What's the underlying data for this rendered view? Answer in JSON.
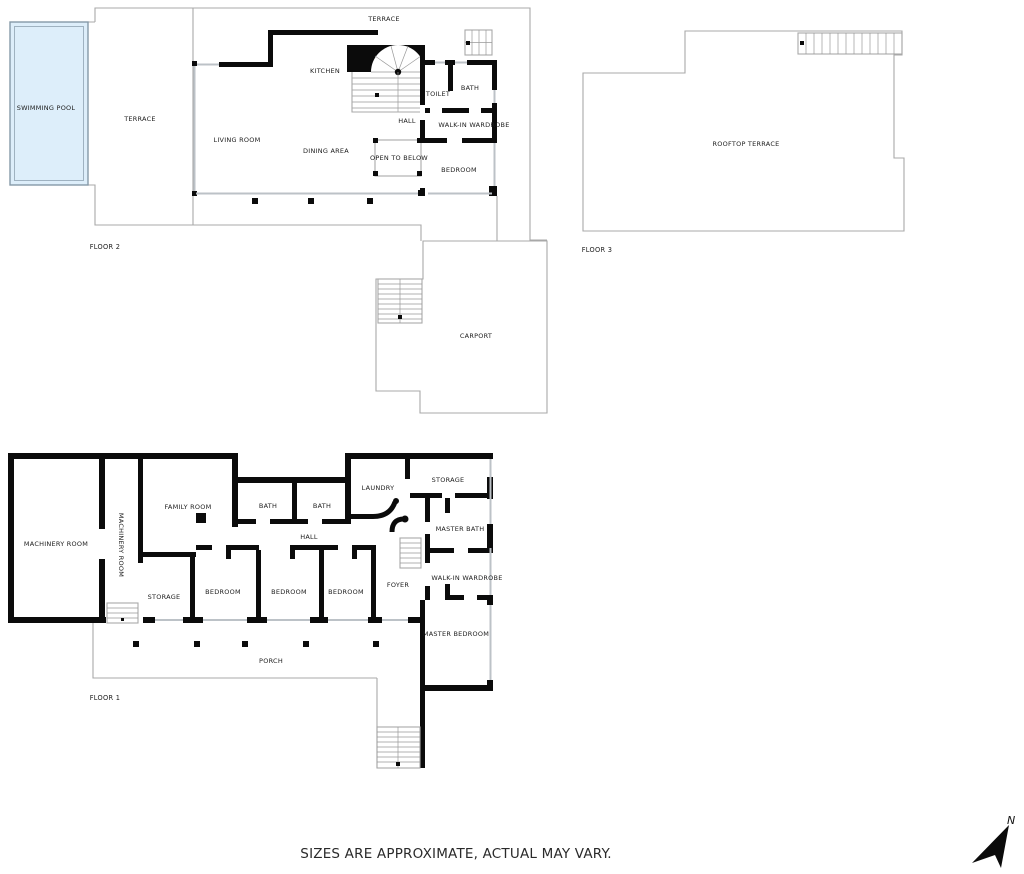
{
  "note": {
    "text": "SIZES ARE APPROXIMATE, ACTUAL MAY VARY."
  },
  "north": {
    "label": "N"
  },
  "colors": {
    "wall": "#0b0b0b",
    "outline": "#a8a8a8",
    "window": "#bcc2c7",
    "pool_fill": "#ddeefa",
    "pool_stroke": "#8599a8",
    "text": "#1c1c1c",
    "bg": "#ffffff"
  },
  "floors": [
    {
      "id": "floor-2",
      "label": {
        "text": "FLOOR 2",
        "x": 105,
        "y": 247
      },
      "rooms": [
        {
          "text": "SWIMMING POOL",
          "x": 46,
          "y": 108
        },
        {
          "text": "TERRACE",
          "x": 140,
          "y": 119
        },
        {
          "text": "TERRACE",
          "x": 384,
          "y": 19
        },
        {
          "text": "KITCHEN",
          "x": 325,
          "y": 71
        },
        {
          "text": "LIVING ROOM",
          "x": 237,
          "y": 140
        },
        {
          "text": "DINING AREA",
          "x": 326,
          "y": 151
        },
        {
          "text": "HALL",
          "x": 407,
          "y": 121
        },
        {
          "text": "OPEN TO BELOW",
          "x": 399,
          "y": 158
        },
        {
          "text": "TOILET",
          "x": 438,
          "y": 94
        },
        {
          "text": "BATH",
          "x": 470,
          "y": 88
        },
        {
          "text": "WALK-IN WARDROBE",
          "x": 474,
          "y": 125
        },
        {
          "text": "BEDROOM",
          "x": 459,
          "y": 170
        }
      ]
    },
    {
      "id": "floor-3",
      "label": {
        "text": "FLOOR 3",
        "x": 597,
        "y": 250
      },
      "rooms": [
        {
          "text": "ROOFTOP TERRACE",
          "x": 746,
          "y": 144
        }
      ]
    },
    {
      "id": "carport",
      "rooms": [
        {
          "text": "CARPORT",
          "x": 476,
          "y": 336
        }
      ]
    },
    {
      "id": "floor-1",
      "label": {
        "text": "FLOOR 1",
        "x": 105,
        "y": 698
      },
      "rooms": [
        {
          "text": "MACHINERY ROOM",
          "x": 56,
          "y": 544
        },
        {
          "text": "MACHINERY ROOM",
          "x": 121,
          "y": 545,
          "rotate": 90
        },
        {
          "text": "FAMILY ROOM",
          "x": 188,
          "y": 507
        },
        {
          "text": "BATH",
          "x": 268,
          "y": 506
        },
        {
          "text": "BATH",
          "x": 322,
          "y": 506
        },
        {
          "text": "LAUNDRY",
          "x": 378,
          "y": 488
        },
        {
          "text": "STORAGE",
          "x": 448,
          "y": 480
        },
        {
          "text": "HALL",
          "x": 309,
          "y": 537
        },
        {
          "text": "STORAGE",
          "x": 164,
          "y": 597
        },
        {
          "text": "BEDROOM",
          "x": 223,
          "y": 592
        },
        {
          "text": "BEDROOM",
          "x": 289,
          "y": 592
        },
        {
          "text": "BEDROOM",
          "x": 346,
          "y": 592
        },
        {
          "text": "FOYER",
          "x": 398,
          "y": 585
        },
        {
          "text": "MASTER BATH",
          "x": 460,
          "y": 529
        },
        {
          "text": "WALK-IN WARDROBE",
          "x": 467,
          "y": 578
        },
        {
          "text": "MASTER BEDROOM",
          "x": 456,
          "y": 634
        },
        {
          "text": "PORCH",
          "x": 271,
          "y": 661
        }
      ]
    }
  ]
}
